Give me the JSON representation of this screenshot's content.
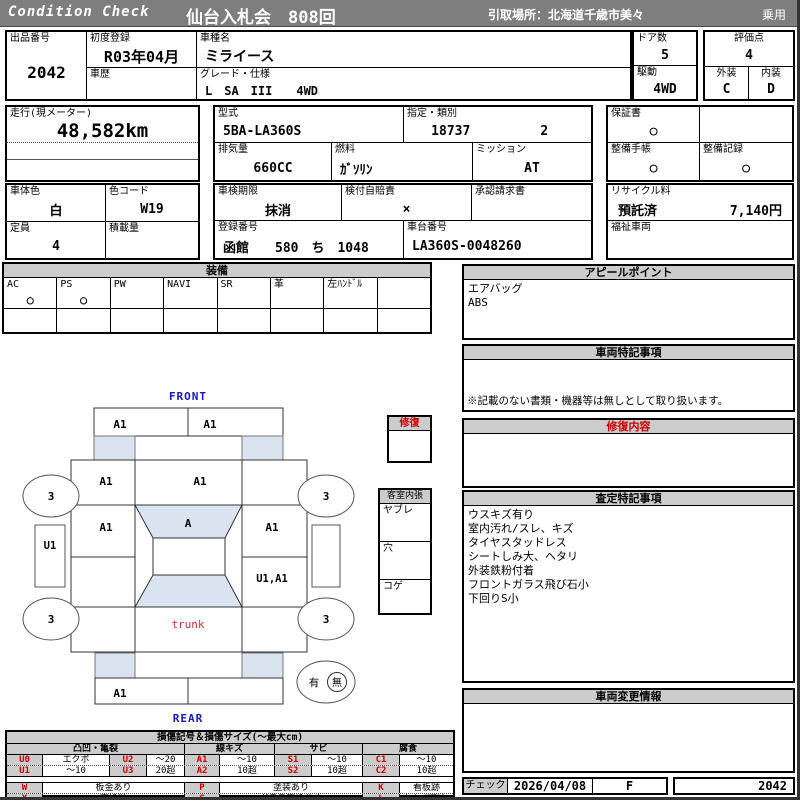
{
  "header": {
    "brand": "Condition  Check",
    "title": "仙台入札会　808回",
    "pickup": "引取場所：北海道千歳市美々",
    "category": "乗用"
  },
  "top": {
    "lot": {
      "label": "出品番号",
      "value": "2042"
    },
    "first_reg": {
      "label": "初度登録",
      "value": "R03年04月"
    },
    "history": {
      "label": "車歴",
      "value": ""
    },
    "model": {
      "label": "車種名",
      "value": "ミライース"
    },
    "grade": {
      "label": "グレード・仕様",
      "value": "L　SA　III　　4WD"
    },
    "doors": {
      "label": "ドア数",
      "value": "5"
    },
    "drive": {
      "label": "駆動",
      "value": "4WD"
    },
    "score": {
      "label": "評価点",
      "value": "4"
    },
    "exterior": {
      "label": "外装",
      "value": "C"
    },
    "interior": {
      "label": "内装",
      "value": "D"
    }
  },
  "row2": {
    "mileage": {
      "label": "走行(現メーター)",
      "value": "48,582km"
    },
    "model_code": {
      "label": "型式",
      "value": "5BA-LA360S"
    },
    "class_no": {
      "label": "指定・類別",
      "value1": "18737",
      "value2": "2"
    },
    "warranty": {
      "label": "保証書",
      "value": "○"
    },
    "displacement": {
      "label": "排気量",
      "value": "660CC"
    },
    "fuel": {
      "label": "燃料",
      "value": "ｶﾞｿﾘﾝ"
    },
    "transmission": {
      "label": "ミッション",
      "value": "AT"
    },
    "service_book": {
      "label": "整備手帳",
      "value": "○"
    },
    "service_record": {
      "label": "整備記録",
      "value": "○"
    }
  },
  "row3": {
    "body_color": {
      "label": "車体色",
      "value": "白"
    },
    "color_code": {
      "label": "色コード",
      "value": "W19"
    },
    "inspection": {
      "label": "車検期限",
      "value": "抹消"
    },
    "liability": {
      "label": "検付自賠責",
      "value": "×"
    },
    "approval": {
      "label": "承認請求書",
      "value": ""
    },
    "recycle": {
      "label": "リサイクル料",
      "status": "預託済",
      "fee": "7,140円"
    },
    "capacity": {
      "label": "定員",
      "value": "4"
    },
    "payload": {
      "label": "積載量",
      "value": ""
    },
    "plate": {
      "label": "登録番号",
      "value": "函館　　580　ち　1048"
    },
    "chassis": {
      "label": "車台番号",
      "value": "LA360S-0048260"
    },
    "welfare": {
      "label": "福祉車両",
      "value": ""
    }
  },
  "equipment": {
    "title": "装備",
    "items": [
      {
        "label": "AC",
        "value": "○"
      },
      {
        "label": "PS",
        "value": "○"
      },
      {
        "label": "PW",
        "value": ""
      },
      {
        "label": "NAVI",
        "value": ""
      },
      {
        "label": "SR",
        "value": ""
      },
      {
        "label": "革",
        "value": ""
      },
      {
        "label": "左ﾊﾝﾄﾞﾙ",
        "value": ""
      },
      {
        "label": "",
        "value": ""
      }
    ]
  },
  "panels": {
    "appeal": {
      "title": "アピールポイント",
      "lines": [
        "エアバッグ",
        "ABS"
      ]
    },
    "vehicle_notes": {
      "title": "車両特記事項",
      "note": "※記載のない書類・機器等は無しとして取り扱います。"
    },
    "repair": {
      "title": "修復内容"
    },
    "assessment": {
      "title": "査定特記事項",
      "lines": [
        "ウスキズ有り",
        "室内汚れ/スレ、キズ",
        "タイヤスタッドレス",
        "シートしみ大、ヘタリ",
        "外装鉄粉付着",
        "フロントガラス飛び石小",
        "下回りS小"
      ]
    },
    "change_info": {
      "title": "車両変更情報"
    }
  },
  "check": {
    "label": "チェック",
    "date": "2026/04/08",
    "grade": "F",
    "lot": "2042"
  },
  "diagram": {
    "front": "FRONT",
    "rear": "REAR",
    "trunk": "trunk",
    "bumper_front_left": "A1",
    "bumper_front_right": "A1",
    "fender_front_left": "A1",
    "hood": "A1",
    "door_front_left": "A1",
    "windshield": "A",
    "door_front_right": "A1",
    "sill_left": "U1",
    "door_rear_right": "U1,A1",
    "bumper_rear_left": "A1",
    "wheel_fl": "3",
    "wheel_fr": "3",
    "wheel_rl": "3",
    "wheel_rr": "3",
    "tool_yes": "有",
    "tool_no": "無",
    "repair_box": {
      "title": "修復"
    },
    "cabin_box": {
      "title": "客室内張",
      "items": [
        "ヤブレ",
        "穴",
        "コゲ"
      ]
    }
  },
  "legend": {
    "title": "損傷記号＆損傷サイズ(～最大cm)",
    "groups": [
      "凸凹・亀裂",
      "線キズ",
      "サビ",
      "腐食"
    ],
    "row1": [
      "U0",
      "エクボ",
      "U2",
      "～20",
      "A1",
      "～10",
      "S1",
      "～10",
      "C1",
      "～10"
    ],
    "row2": [
      "U1",
      "～10",
      "U3",
      "20超",
      "A2",
      "10超",
      "S2",
      "10超",
      "C2",
      "10超"
    ],
    "row3": [
      "W",
      "板金あり",
      "P",
      "塗装あり",
      "K",
      "看板跡"
    ],
    "row4": [
      "X",
      "交換跡",
      "G",
      "ガラス交換要す",
      "L",
      "レンズ割れ"
    ]
  }
}
